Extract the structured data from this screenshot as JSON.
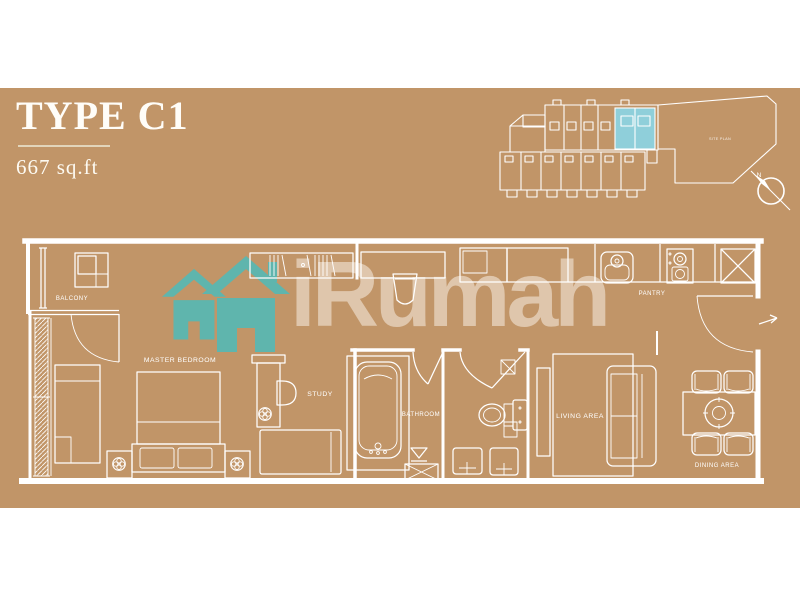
{
  "header": {
    "title": "TYPE C1",
    "area": "667 sq.ft"
  },
  "watermark": {
    "brand": "iRumah"
  },
  "key_plan": {
    "site_label": "SITE PLAN"
  },
  "north_indicator": {
    "label": "N"
  },
  "floor_plan": {
    "labels": {
      "balcony": "BALCONY",
      "master_bedroom": "MASTER BEDROOM",
      "study": "STUDY",
      "bathroom": "BATHROOM",
      "pantry": "PANTRY",
      "living_area": "LIVING AREA",
      "dining_area": "DINING AREA"
    }
  },
  "colors": {
    "background": "#ffffff",
    "panel": "#c19568",
    "plan_lines": "#ffffff",
    "brand_teal": "#5fb5ad",
    "keyplan_highlight": "#8fcfda",
    "watermark_text": "rgba(253,248,240,0.5)"
  }
}
